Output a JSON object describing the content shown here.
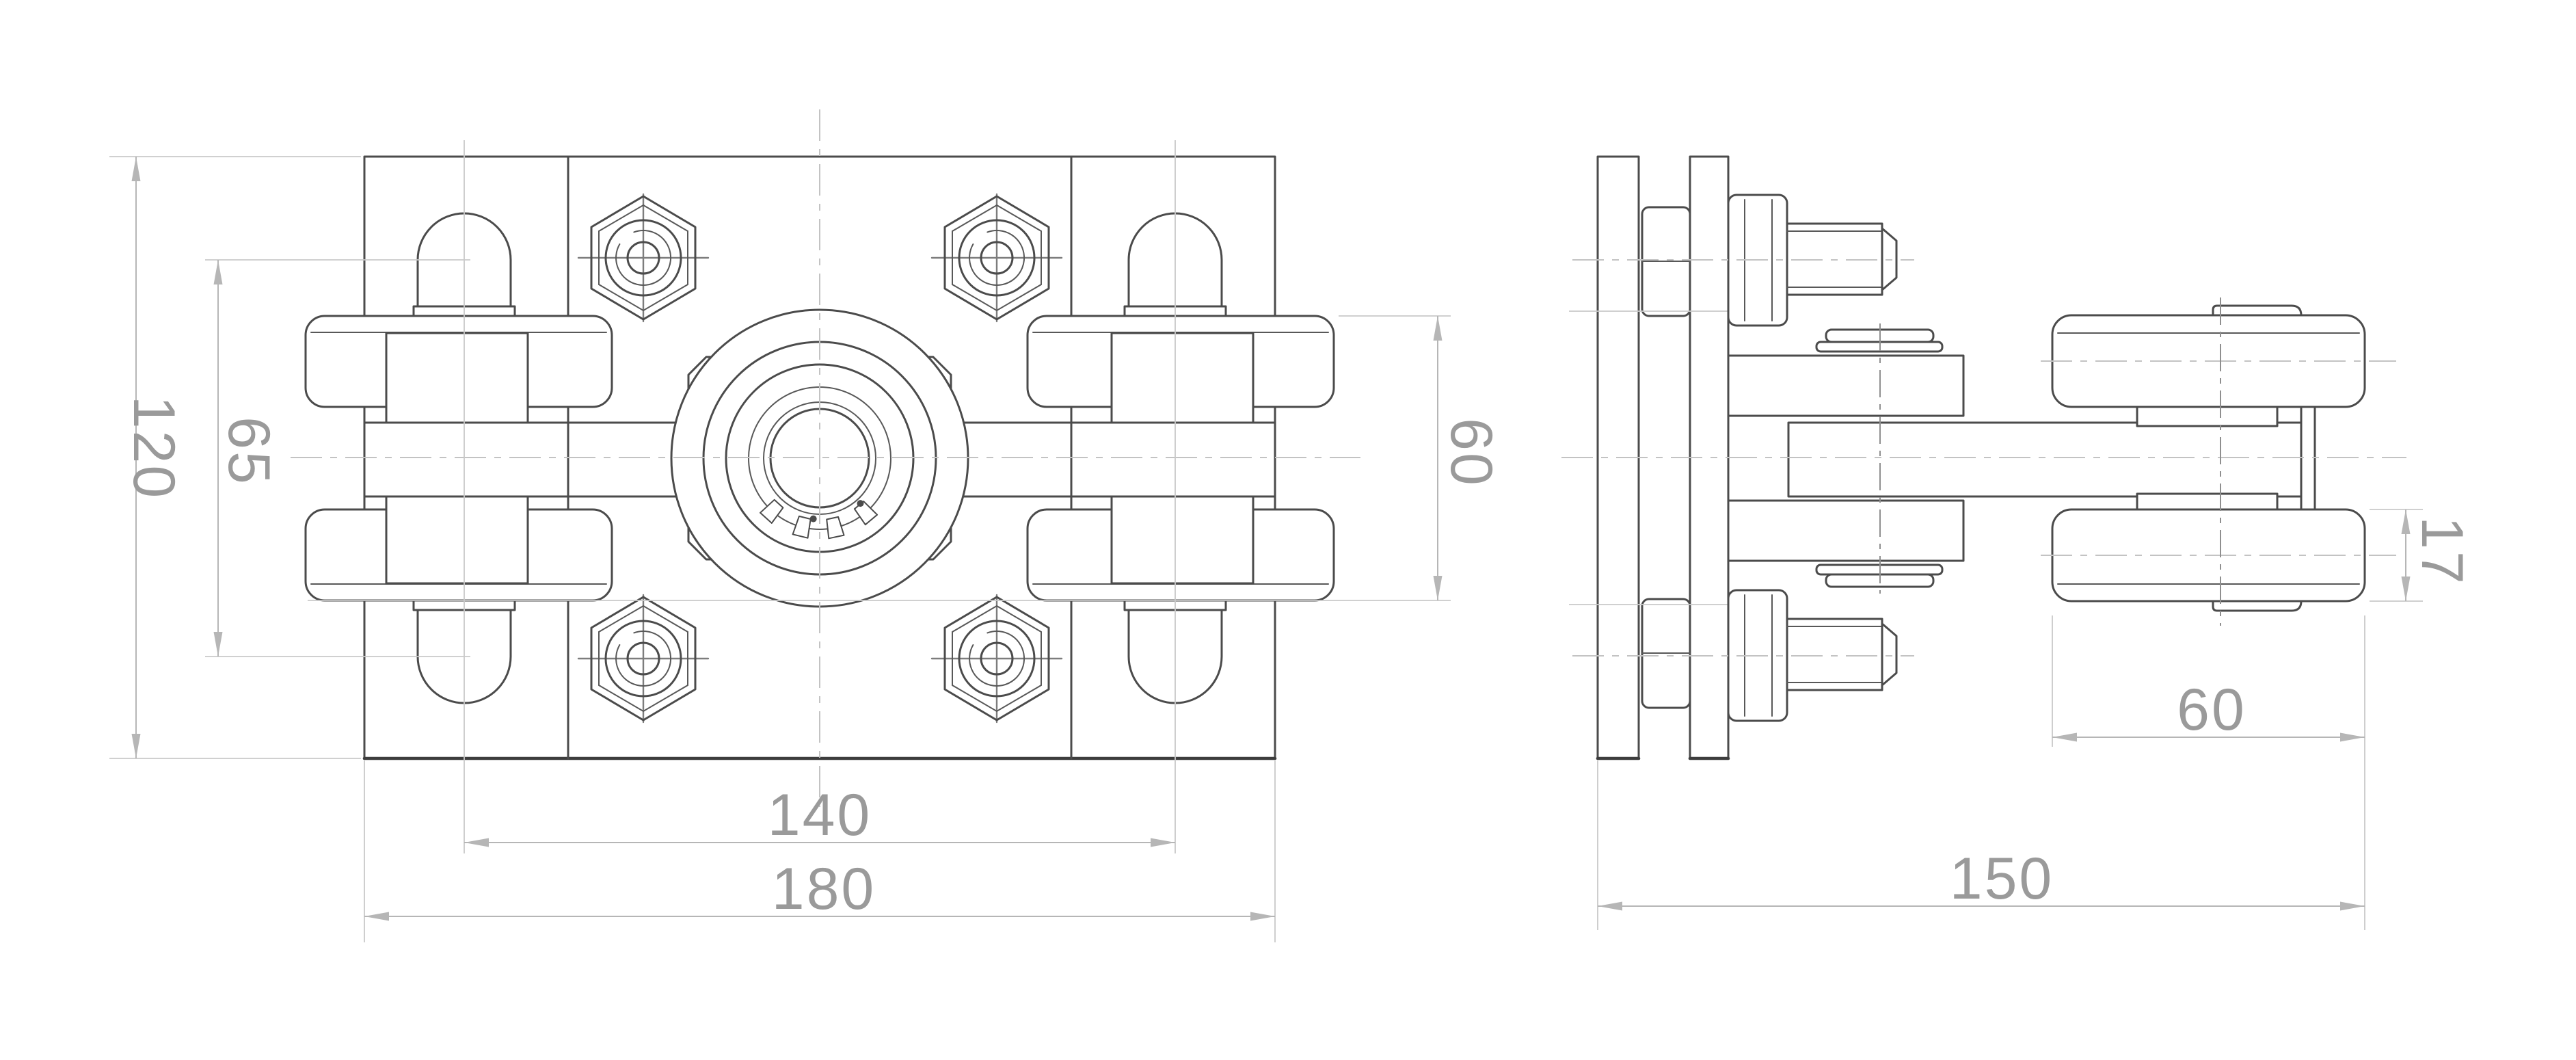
{
  "drawing": {
    "type": "technical-drawing",
    "background": "#ffffff",
    "line_color": "#4b4b4b",
    "dim_line_color": "#b6b6b6",
    "text_color": "#9a9a9a",
    "views": {
      "front": {
        "label": "front-view",
        "dimensions": {
          "overall_height": "120",
          "slot_span": "65",
          "roller_stack_height": "60",
          "bolt_hole_spacing": "140",
          "overall_width": "180"
        }
      },
      "side": {
        "label": "side-view",
        "dimensions": {
          "roller_width": "60",
          "roller_rim_thickness": "17",
          "overall_depth": "150"
        }
      }
    }
  }
}
